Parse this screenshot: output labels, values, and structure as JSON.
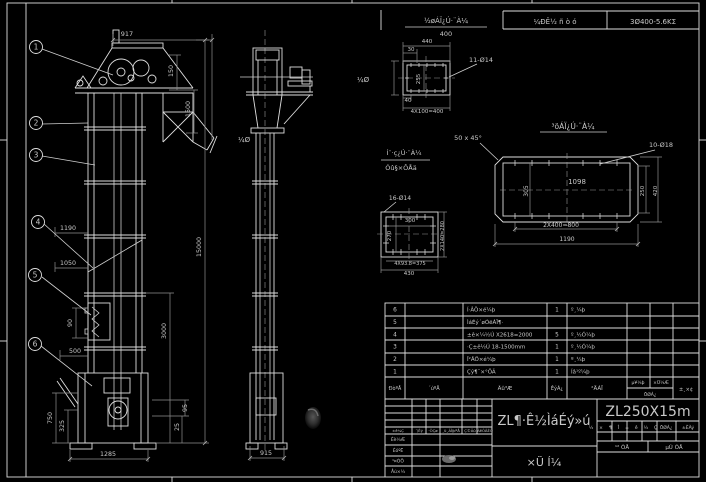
{
  "colors": {
    "background": "#000000",
    "line": "#dedede",
    "dim_line": "#8f8f8f",
    "text": "#c9c9c9",
    "title_text": "#b8b8b8"
  },
  "top_bar": {
    "note_title": "½øÁÏ¿Ú·¨À¼",
    "note_value": "400",
    "field_left": "¼ÐÊ½ ñ ò ó",
    "field_right": "3Ø400-5.6ΚΣ"
  },
  "annotations": {
    "detail_b_title": "³öÁÏ¿Ú·¨À¼",
    "detail_c_title_line1": "Í¨·ç¿Ú·¨À¼",
    "detail_c_title_line2": "Óû§×ÔÅä"
  },
  "drawing_title": "ZL¶·Ê½ÌáÉý»ú",
  "model": "ZL250X15m",
  "labels": [
    {
      "t": "917",
      "x": 127,
      "y": 36,
      "fs": 6.5
    },
    {
      "t": "150",
      "x": 173,
      "y": 71,
      "r": -90
    },
    {
      "t": "1500",
      "x": 190,
      "y": 109,
      "r": -90
    },
    {
      "t": "15000",
      "x": 201,
      "y": 247,
      "r": -90
    },
    {
      "t": "3000",
      "x": 166,
      "y": 331,
      "r": -90
    },
    {
      "t": "1190",
      "x": 68,
      "y": 230
    },
    {
      "t": "1050",
      "x": 68,
      "y": 265
    },
    {
      "t": "90",
      "x": 72,
      "y": 323,
      "r": -90
    },
    {
      "t": "500",
      "x": 75,
      "y": 353
    },
    {
      "t": "750",
      "x": 52,
      "y": 418,
      "r": -90
    },
    {
      "t": "325",
      "x": 64,
      "y": 426,
      "r": -90
    },
    {
      "t": "1285",
      "x": 108,
      "y": 456
    },
    {
      "t": "95",
      "x": 187,
      "y": 408,
      "r": -90
    },
    {
      "t": "25",
      "x": 179,
      "y": 427,
      "r": -90
    },
    {
      "t": "915",
      "x": 266,
      "y": 455
    },
    {
      "t": "440",
      "x": 427,
      "y": 43,
      "fs": 5.5
    },
    {
      "t": "30",
      "x": 411,
      "y": 51,
      "fs": 5.5
    },
    {
      "t": "255",
      "x": 420,
      "y": 79,
      "r": -90,
      "fs": 5.5
    },
    {
      "t": "40",
      "x": 408,
      "y": 102,
      "fs": 5.5
    },
    {
      "t": "4X100=400",
      "x": 427,
      "y": 113,
      "fs": 5.5
    },
    {
      "t": "11-Ø14",
      "x": 481,
      "y": 62,
      "fs": 6.5
    },
    {
      "t": "50 x 45°",
      "x": 468,
      "y": 140,
      "fs": 6.5
    },
    {
      "t": "10-Ø18",
      "x": 661,
      "y": 147,
      "fs": 6.5
    },
    {
      "t": "1098",
      "x": 577,
      "y": 184,
      "fs": 7
    },
    {
      "t": "305",
      "x": 528,
      "y": 191,
      "r": -90,
      "fs": 6
    },
    {
      "t": "250",
      "x": 644,
      "y": 191,
      "r": -90,
      "fs": 5.5
    },
    {
      "t": "420",
      "x": 657,
      "y": 191,
      "r": -90,
      "fs": 5.5
    },
    {
      "t": "2X400=800",
      "x": 561,
      "y": 227,
      "fs": 6
    },
    {
      "t": "1190",
      "x": 567,
      "y": 241,
      "fs": 6
    },
    {
      "t": "16-Ø14",
      "x": 400,
      "y": 200,
      "fs": 6
    },
    {
      "t": "300",
      "x": 410,
      "y": 222,
      "fs": 5.5
    },
    {
      "t": "270",
      "x": 391,
      "y": 236,
      "r": -90,
      "fs": 5.5
    },
    {
      "t": "2X140=280",
      "x": 444,
      "y": 236,
      "r": -90,
      "fs": 5
    },
    {
      "t": "4X93.8=375",
      "x": 410,
      "y": 265,
      "fs": 5
    },
    {
      "t": "430",
      "x": 409,
      "y": 275,
      "fs": 5.5
    },
    {
      "t": "¼Ø",
      "x": 244,
      "y": 142,
      "fs": 7,
      "c": "#3f3f3f"
    },
    {
      "t": "¼Ø",
      "x": 363,
      "y": 82,
      "fs": 7,
      "c": "#3a3a3a"
    }
  ],
  "balloons": [
    {
      "n": "1",
      "x": 36,
      "y": 47
    },
    {
      "n": "2",
      "x": 36,
      "y": 123
    },
    {
      "n": "3",
      "x": 36,
      "y": 155
    },
    {
      "n": "4",
      "x": 38,
      "y": 222
    },
    {
      "n": "5",
      "x": 35,
      "y": 275
    },
    {
      "n": "6",
      "x": 35,
      "y": 344
    }
  ],
  "bom": {
    "header": {
      "no": "ÐòºÅ",
      "code": "´úºÅ",
      "name": "Ãû³Æ",
      "qty": "ÊýÁ¿",
      "material": "²ÄÁÏ",
      "unit": "µ¥¼þ",
      "total": "×Ü¼Æ",
      "weight": "ÖØÁ¿",
      "remark": "±¸×¢"
    },
    "rows": [
      {
        "no": "6",
        "code": "",
        "name": "Í·ÂÖ×é¼þ",
        "qty": "1",
        "material": "º¸¼þ"
      },
      {
        "no": "5",
        "code": "",
        "name": "ÌáÉý´øÓëÁÏ¶·",
        "qty": "",
        "material": ""
      },
      {
        "no": "4",
        "code": "",
        "name": "±ê×¼½Ú X2618=2000",
        "qty": "5",
        "material": "º¸½Ó¼þ"
      },
      {
        "no": "3",
        "code": "",
        "name": "·Ç±ê½Ú 18-1500mm",
        "qty": "1",
        "material": "º¸½Ó¼þ"
      },
      {
        "no": "2",
        "code": "",
        "name": "Î²ÂÖ×é¼þ",
        "qty": "1",
        "material": "º¸¼þ"
      },
      {
        "no": "1",
        "code": "",
        "name": "Çý¶¯×°ÖÃ",
        "qty": "1",
        "material": "Íâ¹º¼þ"
      }
    ]
  },
  "title_block": {
    "title": "ZL¶·Ê½ÌáÉý»ú",
    "subtitle": "×Ü Í¼",
    "model": "ZL250X15m",
    "stage_label": "½×¶Î±ê¼Ç",
    "weight_label": "ÖØÁ¿",
    "scale_label": "±ÈÀý",
    "sheets_label": "¹² ÕÅ",
    "sheet_label": "µÚ ÕÅ",
    "rev_headers": [
      "±ê¼Ç",
      "´¦Êý",
      "·ÖÇø",
      "¸ü¸ÄÎļþºÅ",
      "Ç©Ãû",
      "ÄêÔÂÈÕ"
    ],
    "sign_rows": [
      "Éè¼Æ",
      "ÉóºË",
      "¹¤ÒÕ",
      "Åú×¼"
    ]
  }
}
